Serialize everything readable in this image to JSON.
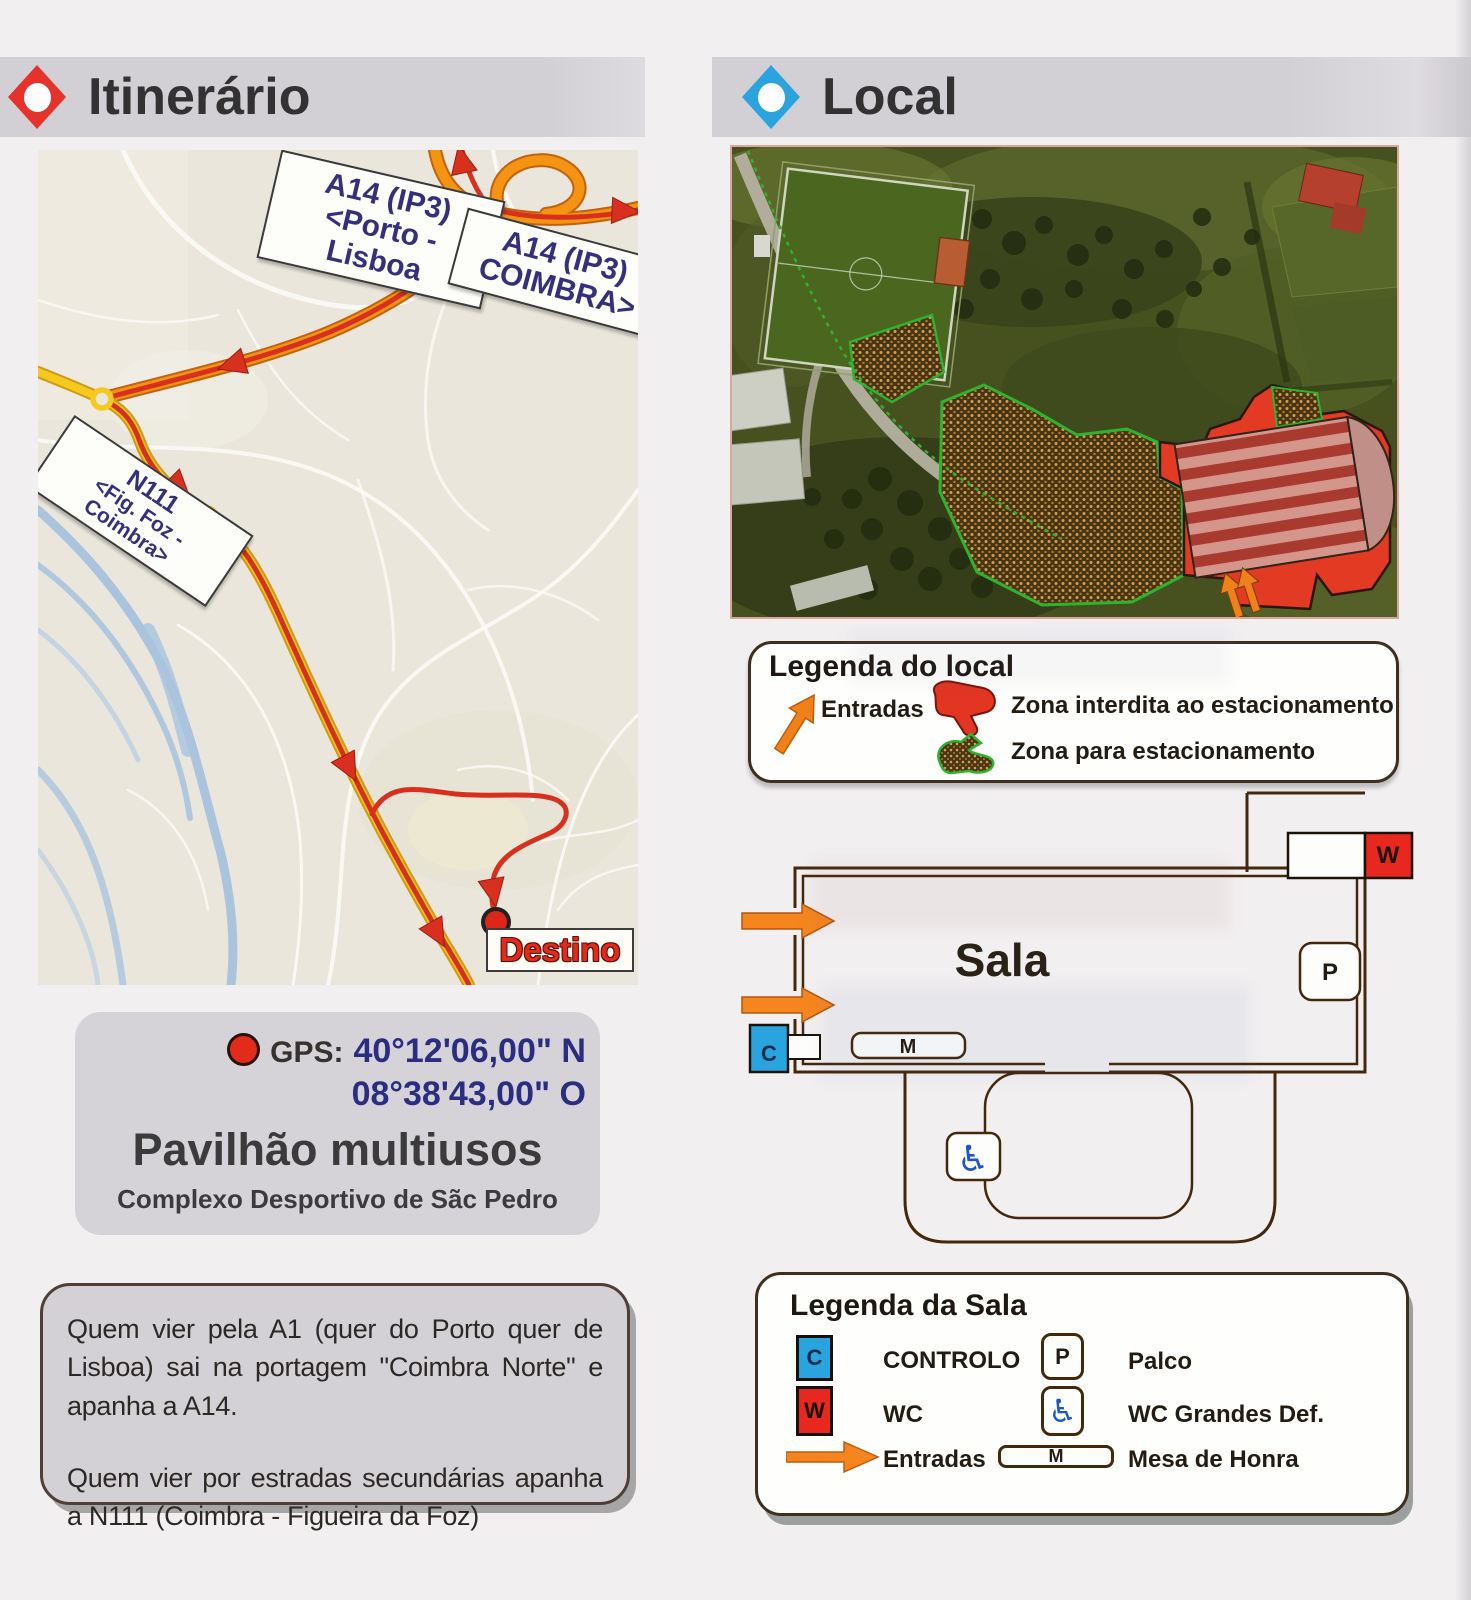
{
  "left_column": {
    "header": {
      "title": "Itinerário",
      "icon": "red-diamond"
    },
    "map": {
      "labels": {
        "a14_porto": {
          "line1": "A14 (IP3)",
          "line2": "<Porto - Lisboa"
        },
        "a14_coimbra": {
          "line1": "A14 (IP3)",
          "line2": "COIMBRA>"
        },
        "n111": {
          "line1": "N111",
          "line2": "<Fig. Foz - Coimbra>"
        },
        "destino": "Destino"
      }
    },
    "gps_card": {
      "gps_label": "GPS:",
      "latitude": "40°12'06,00\" N",
      "longitude": "08°38'43,00\" O",
      "venue": "Pavilhão multiusos",
      "complex": "Complexo Desportivo de Sãc Pedro"
    },
    "directions_card": {
      "paragraph1": "Quem vier pela A1 (quer do Porto quer de Lisboa) sai na portagem \"Coimbra Norte\" e apanha a A14.",
      "paragraph2": "Quem vier por estradas secundárias apanha a N111 (Coimbra - Figueira da Foz)"
    }
  },
  "right_column": {
    "header": {
      "title": "Local",
      "icon": "blue-diamond"
    },
    "site_legend": {
      "title": "Legenda do local",
      "entries": [
        {
          "icon": "orange-arrow",
          "label": "Entradas"
        },
        {
          "icon": "red-no-parking-zone",
          "label": "Zona interdita ao estacionamento"
        },
        {
          "icon": "green-parking-zone",
          "label": "Zona para estacionamento"
        }
      ]
    },
    "floorplan": {
      "room": "Sala",
      "markers": {
        "control": "C",
        "wc": "W",
        "stage": "P",
        "table": "M"
      },
      "wheelchair_icon": "♿"
    },
    "room_legend": {
      "title": "Legenda da Sala",
      "entries": [
        {
          "icon": "blue-square",
          "symbol": "C",
          "label": "CONTROLO"
        },
        {
          "icon": "red-square",
          "symbol": "W",
          "label": "WC"
        },
        {
          "icon": "orange-arrow",
          "symbol": "",
          "label": "Entradas"
        },
        {
          "icon": "stage-box",
          "symbol": "P",
          "label": "Palco"
        },
        {
          "icon": "wheelchair",
          "symbol": "♿",
          "label": "WC Grandes Def."
        },
        {
          "icon": "table-box",
          "symbol": "M",
          "label": "Mesa de Honra"
        }
      ]
    }
  },
  "colors": {
    "header_bar": "#d3d0d5",
    "red_accent": "#e5332b",
    "blue_accent": "#2aa3df",
    "orange_arrow": "#f08019",
    "route_red": "#d8301f",
    "road_orange": "#f59313",
    "road_yellow": "#f6c91f",
    "river_blue": "#aac4de",
    "wall_brown": "#43280c",
    "gps_blue": "#2b2d80"
  }
}
